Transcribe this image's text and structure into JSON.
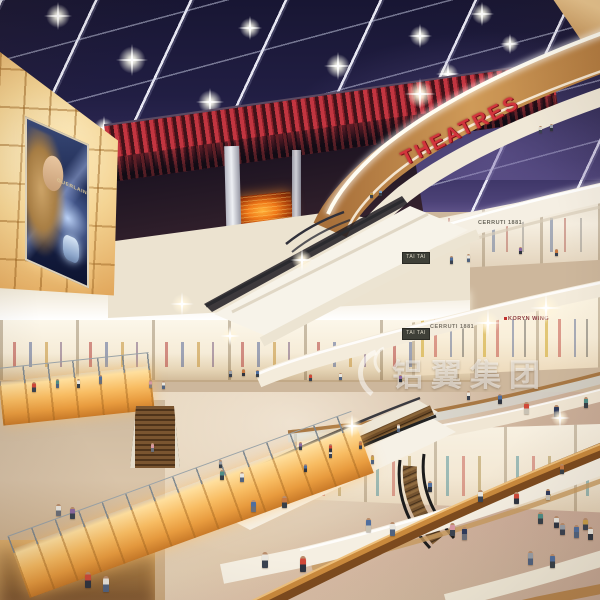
{
  "scene": {
    "type": "shopping-mall-atrium-rendering",
    "time_of_day": "night-skylight"
  },
  "signs": {
    "theatres": "THEATRES",
    "tai_tai": "TAI TAI",
    "cerruti": "CERRUTI 1881",
    "koryn_wing": "KORYN WING"
  },
  "billboard": {
    "brand": "GUERLAIN"
  },
  "watermark": {
    "text": "铝翼集团"
  },
  "colors": {
    "theatre_red": "#d2343c",
    "ceiling_navy": "#221f44",
    "wood_fascia": "#bd8a50",
    "cream_fascia": "#f5efe3",
    "amber_glow": "#f8bc62",
    "floor_beige": "#d6c0a4",
    "screen_orange": "#f07818",
    "watermark_white": "rgba(255,255,255,0.52)"
  },
  "stars": [
    [
      58,
      16,
      7
    ],
    [
      132,
      60,
      8
    ],
    [
      210,
      102,
      7
    ],
    [
      296,
      142,
      8
    ],
    [
      26,
      88,
      6
    ],
    [
      104,
      128,
      6
    ],
    [
      250,
      28,
      6
    ],
    [
      338,
      66,
      7
    ],
    [
      420,
      36,
      6
    ],
    [
      482,
      14,
      6
    ],
    [
      368,
      122,
      7
    ],
    [
      448,
      74,
      6
    ],
    [
      176,
      168,
      5
    ],
    [
      510,
      44,
      5
    ]
  ],
  "sparkles": [
    [
      546,
      308,
      8
    ],
    [
      488,
      323,
      7
    ],
    [
      420,
      94,
      8
    ],
    [
      302,
      260,
      6
    ],
    [
      182,
      304,
      6
    ],
    [
      352,
      426,
      6
    ],
    [
      560,
      418,
      5
    ],
    [
      230,
      336,
      5
    ]
  ],
  "people": [
    [
      540,
      133,
      7,
      "#d8d4cc",
      "#3a4250"
    ],
    [
      551,
      131,
      7,
      "#9aa0a8",
      "#2e3440"
    ],
    [
      371,
      198,
      6,
      "#caa04a",
      "#3a4250"
    ],
    [
      380,
      196,
      6,
      "#7aa0c8",
      "#384048"
    ],
    [
      451,
      264,
      8,
      "#4f6e9e",
      "#3a4250"
    ],
    [
      468,
      262,
      8,
      "#e9e6de",
      "#51637f"
    ],
    [
      556,
      256,
      7,
      "#c87840",
      "#3a4250"
    ],
    [
      520,
      254,
      7,
      "#8a68a0",
      "#2e3440"
    ],
    [
      34,
      392,
      10,
      "#d04838",
      "#3a4250"
    ],
    [
      57,
      388,
      9,
      "#4f8d86",
      "#51637f"
    ],
    [
      78,
      388,
      9,
      "#e9e6de",
      "#384048"
    ],
    [
      100,
      384,
      9,
      "#4f6e9e",
      "#6a6e78"
    ],
    [
      150,
      388,
      8,
      "#d898a2",
      "#8a8078"
    ],
    [
      163,
      389,
      8,
      "#e9e6de",
      "#51637f"
    ],
    [
      230,
      377,
      7,
      "#9aa0a8",
      "#3a4250"
    ],
    [
      243,
      376,
      7,
      "#c87840",
      "#2e3440"
    ],
    [
      257,
      377,
      7,
      "#4f6e9e",
      "#384048"
    ],
    [
      310,
      381,
      7,
      "#d04838",
      "#3a4250"
    ],
    [
      340,
      380,
      7,
      "#e9e6de",
      "#51637f"
    ],
    [
      400,
      382,
      7,
      "#8a68a0",
      "#2e3440"
    ],
    [
      468,
      400,
      9,
      "#e9e6de",
      "#3a4250"
    ],
    [
      500,
      404,
      10,
      "#4f6e9e",
      "#2e3440"
    ],
    [
      526,
      414,
      12,
      "#d04838",
      "#c8c2b4"
    ],
    [
      556,
      417,
      12,
      "#2e3a5c",
      "#6a6e78"
    ],
    [
      586,
      408,
      11,
      "#4f8d86",
      "#384048"
    ],
    [
      398,
      432,
      8,
      "#e9e6de",
      "#51637f"
    ],
    [
      360,
      449,
      8,
      "#c87840",
      "#3a4250"
    ],
    [
      305,
      472,
      8,
      "#4f6e9e",
      "#2e3440"
    ],
    [
      152,
      452,
      9,
      "#d898a2",
      "#6a6e78"
    ],
    [
      220,
      468,
      8,
      "#9aa0a8",
      "#384048"
    ],
    [
      330,
      458,
      9,
      "#e9e6de",
      "#3a4250"
    ],
    [
      372,
      464,
      9,
      "#caa04a",
      "#51637f"
    ],
    [
      430,
      492,
      11,
      "#4f6e9e",
      "#2e3440"
    ],
    [
      480,
      502,
      12,
      "#e9e6de",
      "#3a4250"
    ],
    [
      516,
      504,
      12,
      "#d04838",
      "#2e3440"
    ],
    [
      548,
      500,
      11,
      "#2e3a5c",
      "#c8c2b4"
    ],
    [
      562,
      474,
      10,
      "#c87840",
      "#384048"
    ],
    [
      576,
      538,
      13,
      "#4f6e9e",
      "#51637f"
    ],
    [
      590,
      540,
      13,
      "#e9e6de",
      "#2e3440"
    ],
    [
      562,
      535,
      12,
      "#9aa0a8",
      "#3a4250"
    ],
    [
      222,
      480,
      10,
      "#4f8d86",
      "#384048"
    ],
    [
      242,
      482,
      10,
      "#e9e6de",
      "#51637f"
    ],
    [
      300,
      450,
      8,
      "#8a68a0",
      "#3a4250"
    ],
    [
      330,
      452,
      8,
      "#d04838",
      "#2e3440"
    ],
    [
      253,
      512,
      12,
      "#4f6e9e",
      "#6a6e78"
    ],
    [
      284,
      508,
      12,
      "#c87840",
      "#384048"
    ],
    [
      265,
      568,
      16,
      "#e9e6de",
      "#3a4250"
    ],
    [
      303,
      572,
      16,
      "#d04838",
      "#2e3440"
    ],
    [
      368,
      532,
      14,
      "#4f6e9e",
      "#c8c2b4"
    ],
    [
      392,
      536,
      14,
      "#e9e6de",
      "#51637f"
    ],
    [
      452,
      536,
      13,
      "#d898a2",
      "#3a4250"
    ],
    [
      464,
      540,
      13,
      "#2e3a5c",
      "#6a6e78"
    ],
    [
      540,
      524,
      12,
      "#4f8d86",
      "#384048"
    ],
    [
      556,
      528,
      12,
      "#e9e6de",
      "#2e3440"
    ],
    [
      585,
      530,
      12,
      "#caa04a",
      "#3a4250"
    ],
    [
      530,
      565,
      14,
      "#9aa0a8",
      "#51637f"
    ],
    [
      552,
      568,
      14,
      "#4f6e9e",
      "#384048"
    ],
    [
      58,
      516,
      12,
      "#e9e6de",
      "#6a6e78"
    ],
    [
      72,
      519,
      12,
      "#8a68a0",
      "#3a4250"
    ],
    [
      88,
      588,
      16,
      "#d04838",
      "#2e3440"
    ],
    [
      106,
      592,
      16,
      "#e9e6de",
      "#51637f"
    ]
  ]
}
